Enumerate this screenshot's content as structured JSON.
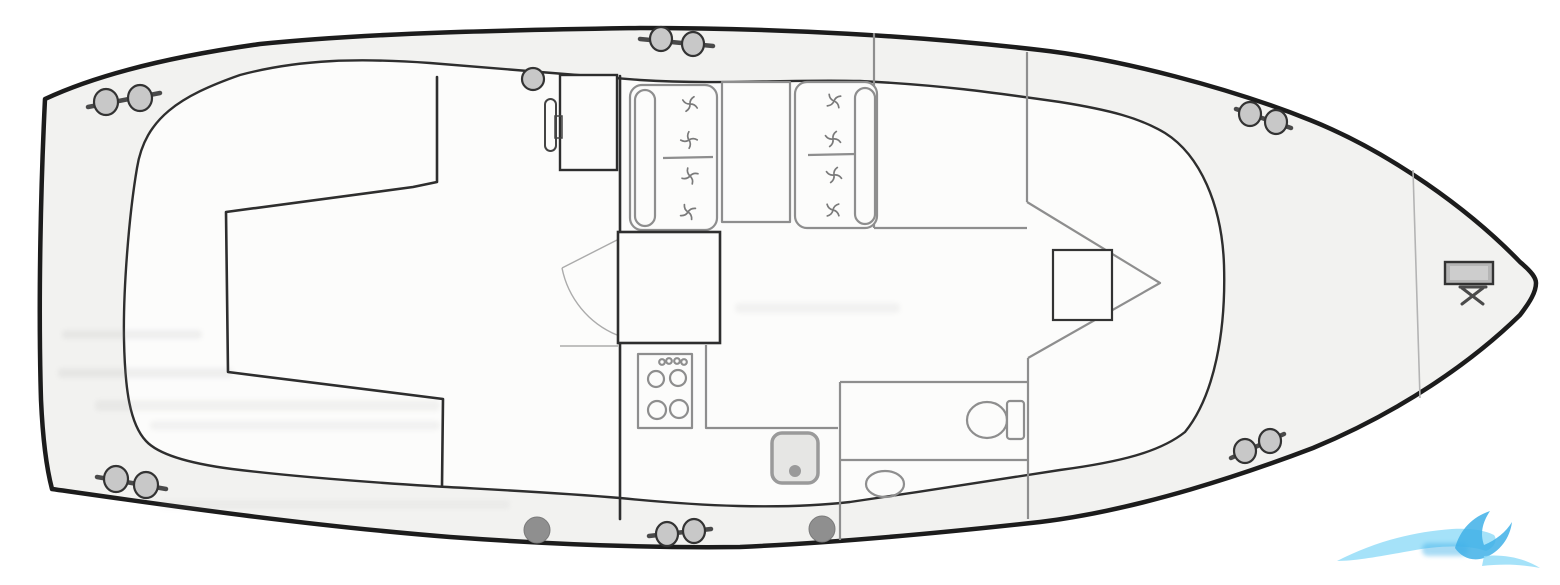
{
  "diagram": {
    "label": "boat-floor-plan",
    "style": "scanned-line-drawing",
    "orientation": "bow-right"
  },
  "components": [
    "hull-outline",
    "side-deck-inner-line",
    "aft-cockpit-structure",
    "helm-console",
    "steering-wheel",
    "mooring-bollard",
    "dinette-settee-port",
    "dinette-table",
    "dinette-settee-starboard",
    "forward-berth",
    "v-berth-outline",
    "berth-hatch",
    "companionway-door",
    "galley-block",
    "galley-shelf",
    "stove",
    "galley-counter",
    "sink",
    "bathroom",
    "toilet",
    "washbasin",
    "bow-locker-bulkhead",
    "anchor-windlass",
    "deck-cleat",
    "deck-fitting",
    "wave-logo-watermark",
    "scan-smudge"
  ],
  "icons": {
    "upholstery_button": "pinwheel-button-icon",
    "cleat": "double-horn-cleat-icon",
    "windlass": "anchor-windlass-icon",
    "watermark": "wave-logo-icon"
  },
  "colors": {
    "page_bg": "#ffffff",
    "ink": "#1c1c1c",
    "ink2": "#2e2e2e",
    "gray": "#8e8e8e",
    "gray_light": "#b4b4b4",
    "deck_fill": "#f2f2f0",
    "cabin_fill": "#fcfcfb",
    "fitting_fill": "#c8c8c8",
    "fitting_dark": "#8f8f8f",
    "door_arc": "#ababab",
    "smudge": "#9a9a9a",
    "watermark_light": "#8edbf7",
    "watermark_dark": "#3fb0e8"
  }
}
